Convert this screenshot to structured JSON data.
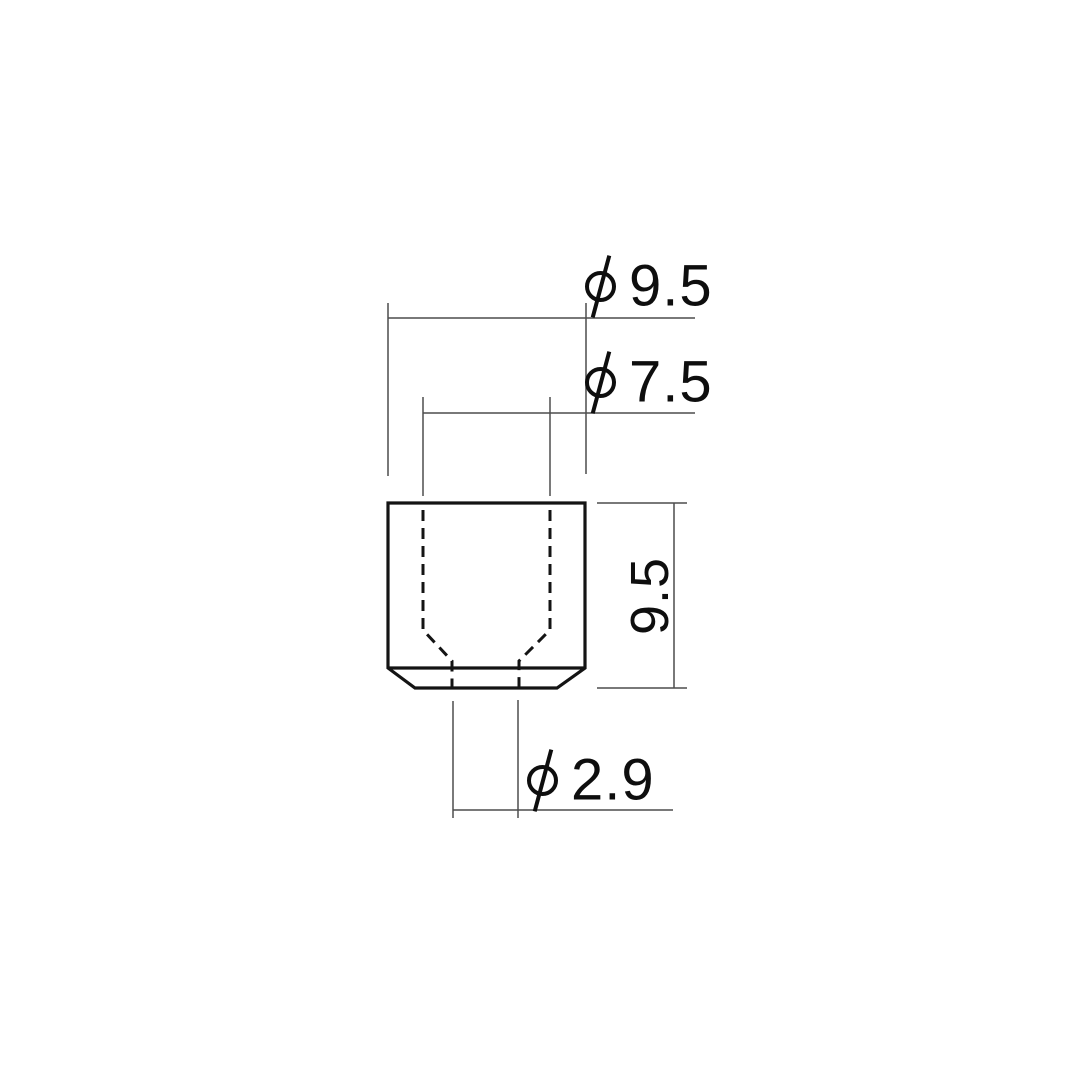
{
  "drawing": {
    "type": "technical-dimension-drawing",
    "background_color": "#ffffff",
    "outline_color": "#141414",
    "dimension_line_color": "#4d4d4d",
    "text_color": "#0e0e0e",
    "dimensions": {
      "outer_diameter": {
        "symbol": "⌀",
        "value": "9.5"
      },
      "counterbore_diameter": {
        "symbol": "⌀",
        "value": "7.5"
      },
      "height": {
        "value": "9.5"
      },
      "through_hole_diameter": {
        "symbol": "⌀",
        "value": "2.9"
      }
    }
  }
}
